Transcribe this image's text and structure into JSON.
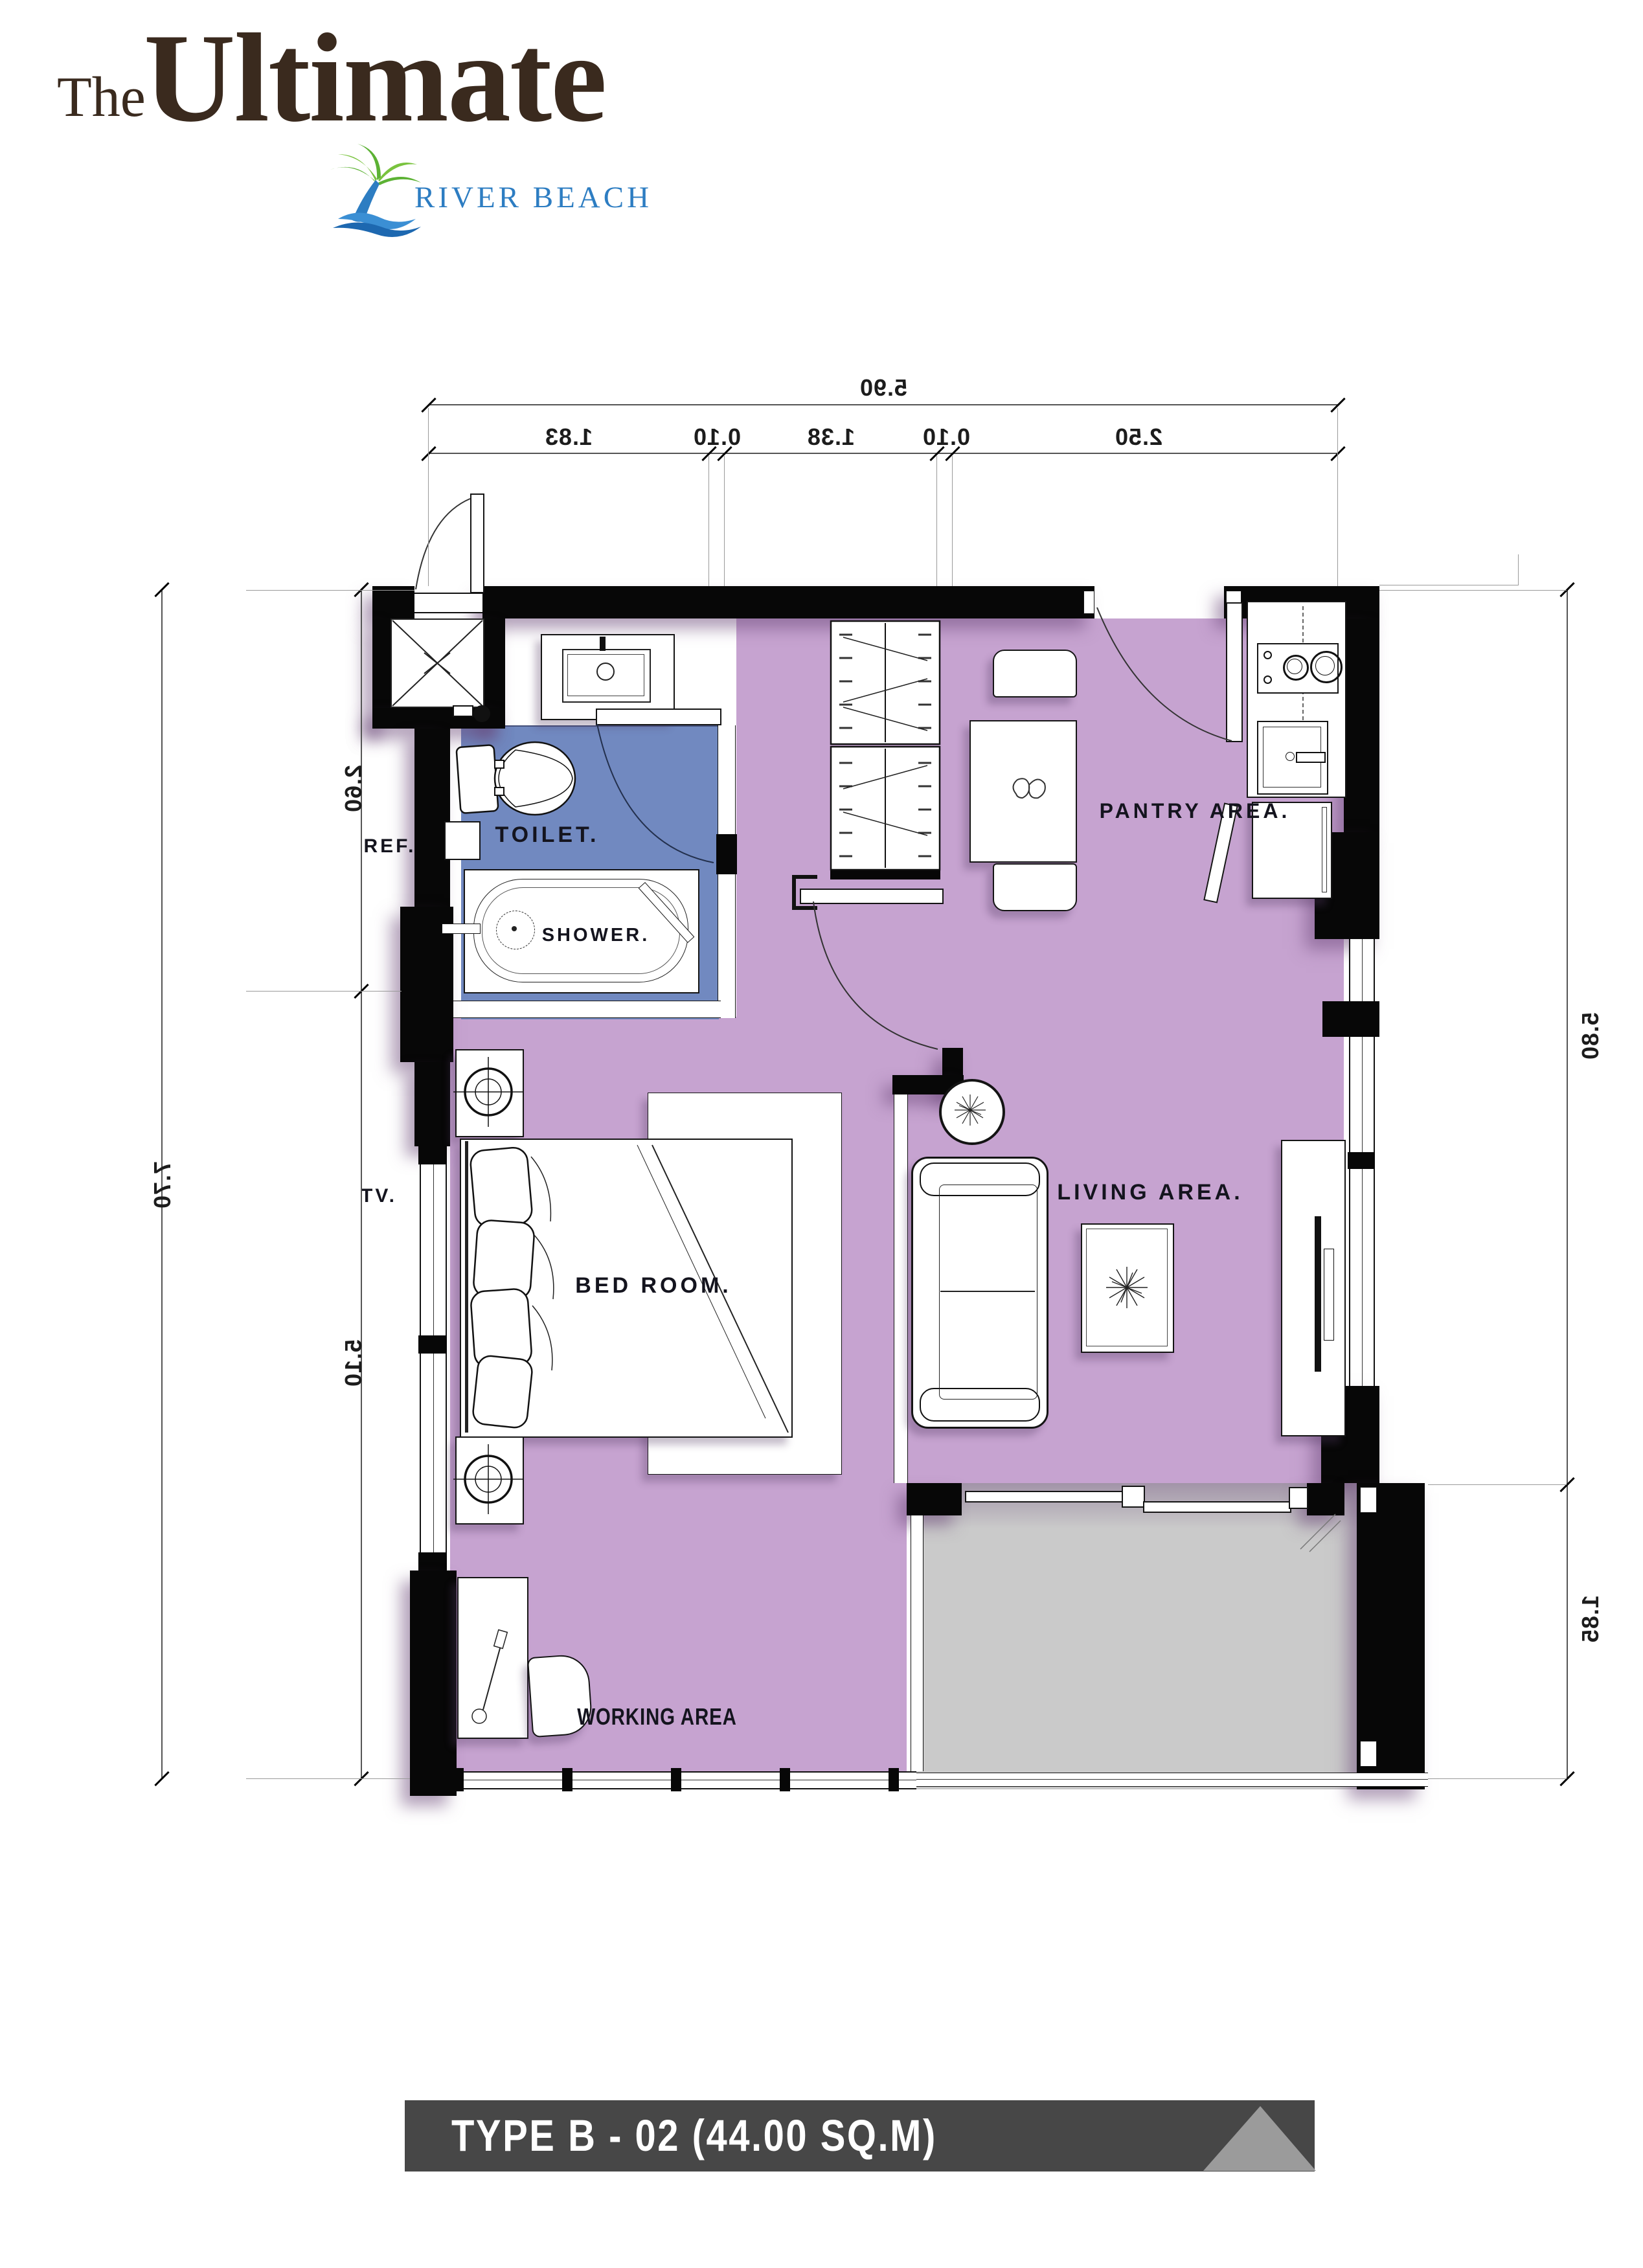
{
  "logo": {
    "prefix": "The",
    "title": "Ultimate",
    "subtitle": "RIVER BEACH"
  },
  "banner": {
    "text": "TYPE B - 02 (44.00 SQ.M)"
  },
  "rooms": {
    "toilet": "TOILET.",
    "shower": "SHOWER.",
    "bedroom": "BED ROOM.",
    "living": "LIVING AREA.",
    "pantry": "PANTRY AREA.",
    "working": "WORKING AREA",
    "ref": "REF.",
    "tv": "TV."
  },
  "dimensions": {
    "top_total": "5.90",
    "top_segments": [
      "1.83",
      "0.10",
      "1.38",
      "0.10",
      "2.50"
    ],
    "left_outer": "7.70",
    "left_segments": [
      "2.60",
      "5.10"
    ],
    "right_segments": [
      "5.80",
      "1.85"
    ]
  },
  "colors": {
    "floor_purple": "#c6a3d0",
    "bath_blue": "#7189c0",
    "balcony_gray": "#cacaca",
    "wall_black": "#070707",
    "banner_gray": "#474747",
    "logo_brown": "#3a2a1e",
    "logo_blue": "#2d7dc2",
    "palm_green": "#5cb234"
  }
}
